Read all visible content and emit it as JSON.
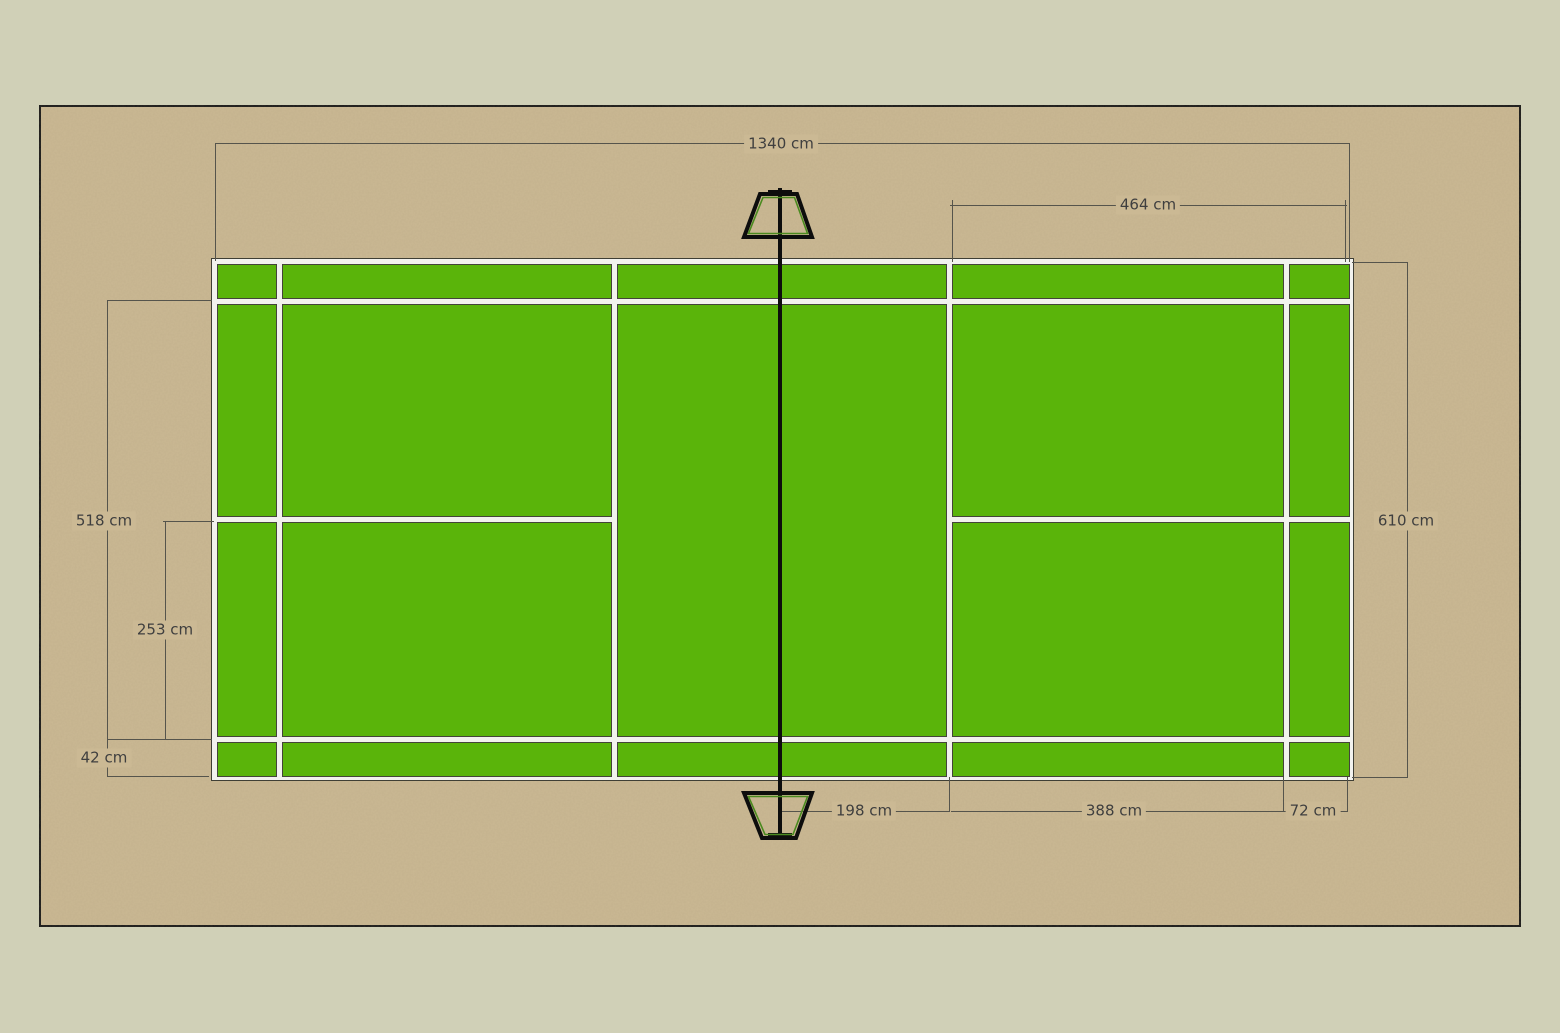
{
  "diagram": {
    "type": "badminton-court-dimension-plan",
    "unit": "cm",
    "labels": {
      "court_length": "1340 cm",
      "service_length_right": "464 cm",
      "singles_width": "518 cm",
      "half_court_width": "253 cm",
      "alley_width": "42 cm",
      "court_width": "610 cm",
      "net_to_short_service_line": "198 cm",
      "short_to_long_service_line": "388 cm",
      "back_alley_depth": "72 cm"
    },
    "colors": {
      "page_background": "#d0d0b7",
      "canvas_background": "#cbb994",
      "canvas_border": "#1a1a1a",
      "court_green": "#5ab40a",
      "court_line_white": "#f2f2ee",
      "cell_outline": "#44443a",
      "dimension_line": "#55544c",
      "label_text": "#3f3f3f",
      "net": "#0d0d0d",
      "post_accent": "#4a8a1f"
    },
    "icons": {
      "net_post_top": "net-post-top-icon",
      "net_post_bottom": "net-post-bottom-icon",
      "net_line": "net-line"
    }
  }
}
